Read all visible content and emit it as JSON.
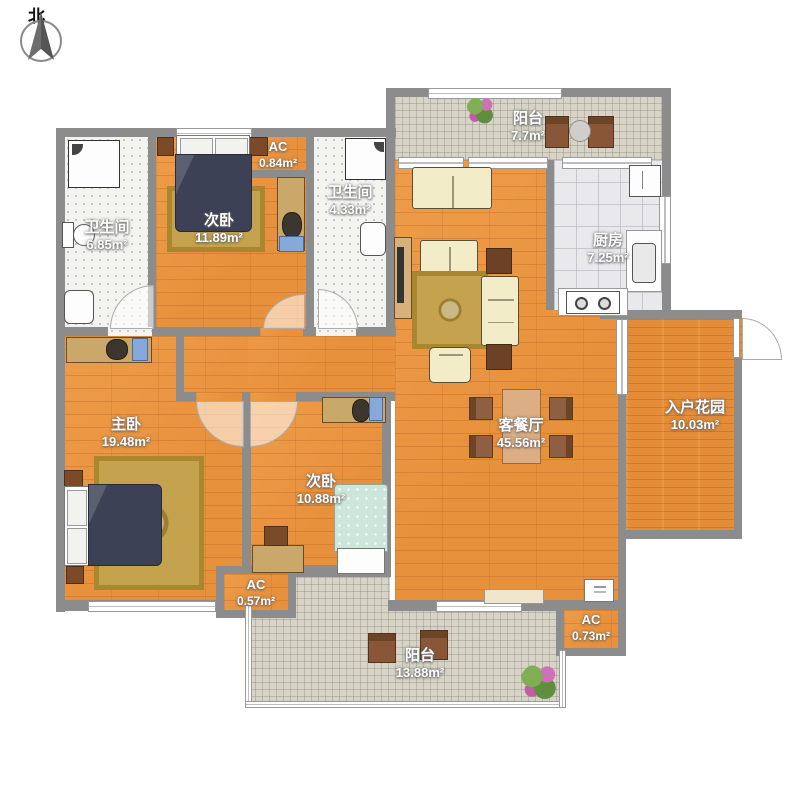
{
  "compass": {
    "north": "北"
  },
  "rooms": {
    "bath_top_left": {
      "name": "卫生间",
      "area": "6.85m²"
    },
    "bedroom_top": {
      "name": "次卧",
      "area": "11.89m²"
    },
    "ac_bedroom_top": {
      "name": "AC",
      "area": "0.84m²"
    },
    "bath_top_mid": {
      "name": "卫生间",
      "area": "4.33m²"
    },
    "balcony_top": {
      "name": "阳台",
      "area": "7.7m²"
    },
    "kitchen": {
      "name": "厨房",
      "area": "7.25m²"
    },
    "living_dining": {
      "name": "客餐厅",
      "area": "45.56m²"
    },
    "entry_garden": {
      "name": "入户花园",
      "area": "10.03m²"
    },
    "master_bedroom": {
      "name": "主卧",
      "area": "19.48m²"
    },
    "bedroom_bottom": {
      "name": "次卧",
      "area": "10.88m²"
    },
    "ac_master": {
      "name": "AC",
      "area": "0.57m²"
    },
    "balcony_bottom": {
      "name": "阳台",
      "area": "13.88m²"
    },
    "ac_living": {
      "name": "AC",
      "area": "0.73m²"
    }
  },
  "colors": {
    "wall": "#8C8C8C",
    "wood_floor": "#E8913D",
    "balcony_tile": "#D7D3C7",
    "bed_blanket": "#3C4156",
    "rug": "#C4A24E"
  }
}
